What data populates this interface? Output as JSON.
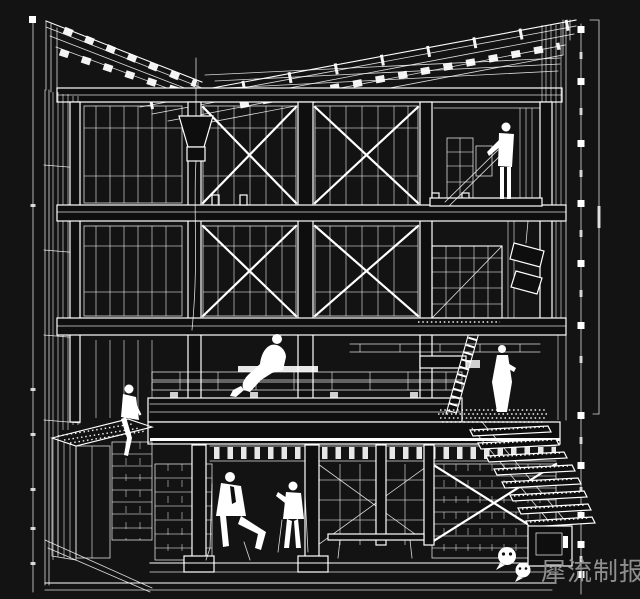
{
  "colors": {
    "page_background": "#161616",
    "drawing_background": "#131313",
    "line": "#ffffff",
    "watermark_text_color": "#8f8f8f"
  },
  "watermark": {
    "icon": "wechat-icon",
    "text": "犀流制报"
  }
}
